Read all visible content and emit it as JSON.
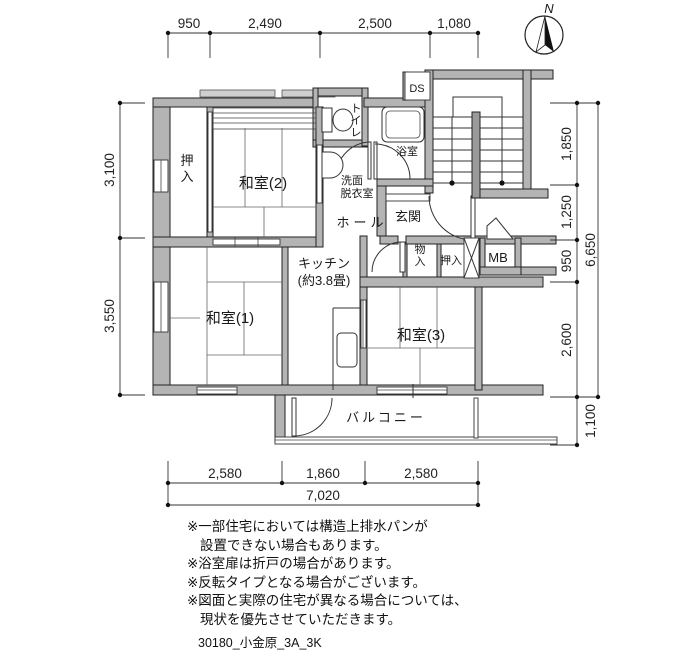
{
  "fp": {
    "compass_label": "N",
    "rooms": {
      "washitsu2": "和室(2)",
      "washitsu1": "和室(1)",
      "washitsu3": "和室(3)",
      "kitchen": "キッチン",
      "kitchen_size": "(約3.8畳)",
      "oshiire_left": "押入",
      "oshiire_right": "押入",
      "monoire": "物入",
      "toilet": "トイレ",
      "bath": "浴室",
      "washroom_line1": "洗面",
      "washroom_line2": "脱衣室",
      "hall": "ホール",
      "genkan": "玄関",
      "balcony": "バルコニー",
      "mb": "MB",
      "ds": "DS"
    },
    "dimensions": {
      "top": [
        "950",
        "2,490",
        "2,500",
        "1,080"
      ],
      "left": [
        "3,100",
        "3,550"
      ],
      "right": [
        "1,850",
        "1,250",
        "950",
        "2,600",
        "1,100"
      ],
      "right_total": "6,650",
      "bottom": [
        "2,580",
        "1,860",
        "2,580"
      ],
      "bottom_total": "7,020"
    },
    "notes": [
      "※一部住宅においては構造上排水パンが",
      "設置できない場合もあります。",
      "※浴室扉は折戸の場合があります。",
      "※反転タイプとなる場合がございます。",
      "※図面と実際の住宅が異なる場合については、",
      "現状を優先させていただきます。"
    ],
    "footer": "30180_小金原_3A_3K"
  }
}
